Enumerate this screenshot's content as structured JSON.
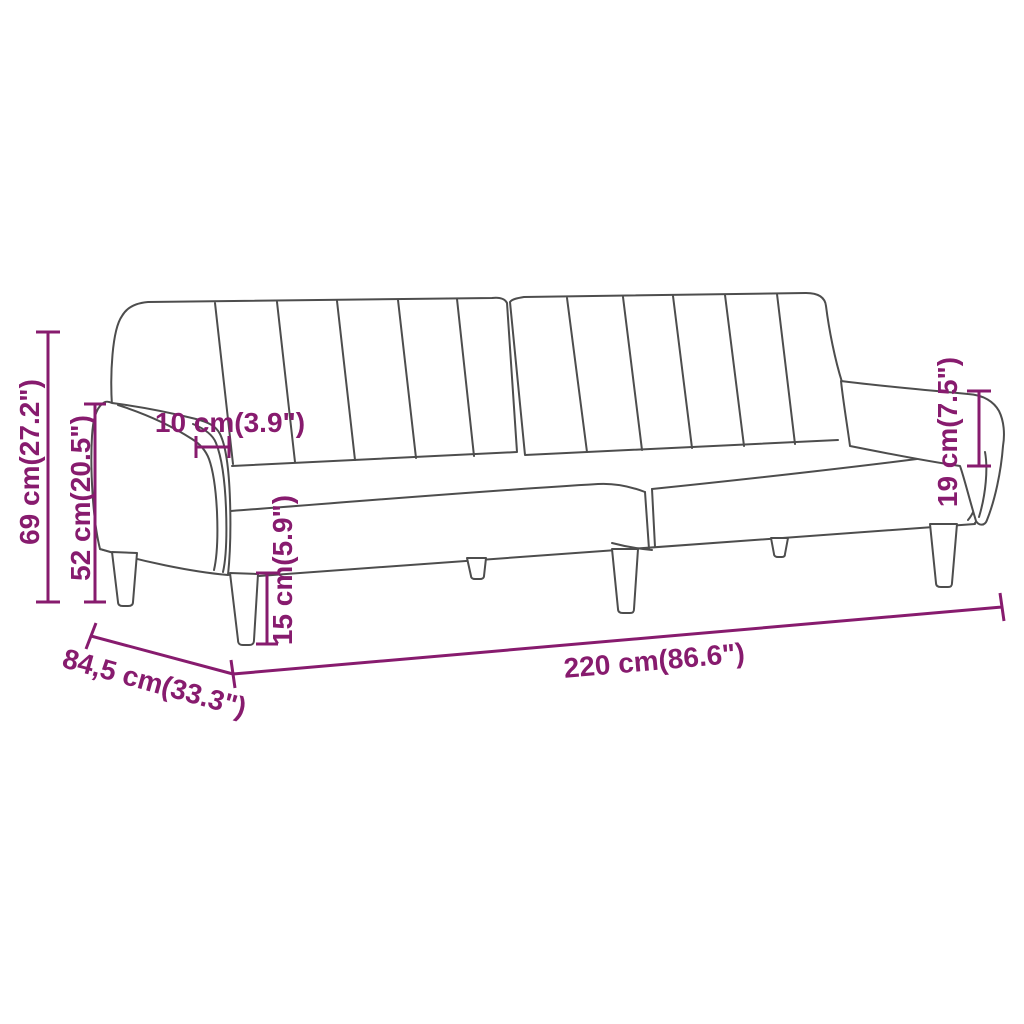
{
  "diagram": {
    "type": "product-dimension-drawing",
    "subject": "sofa-bed-line-drawing",
    "background_color": "#ffffff",
    "outline_color": "#4d4d4d",
    "dimension_color": "#871b6e",
    "labels": {
      "total_height": "69 cm(27.2\")",
      "back_height": "52 cm(20.5\")",
      "armrest_width": "10 cm(3.9\")",
      "leg_height": "15 cm(5.9\")",
      "armrest_above_seat": "19 cm(7.5\")",
      "total_length": "220 cm(86.6\")",
      "depth": "84,5 cm(33.3\")"
    }
  }
}
